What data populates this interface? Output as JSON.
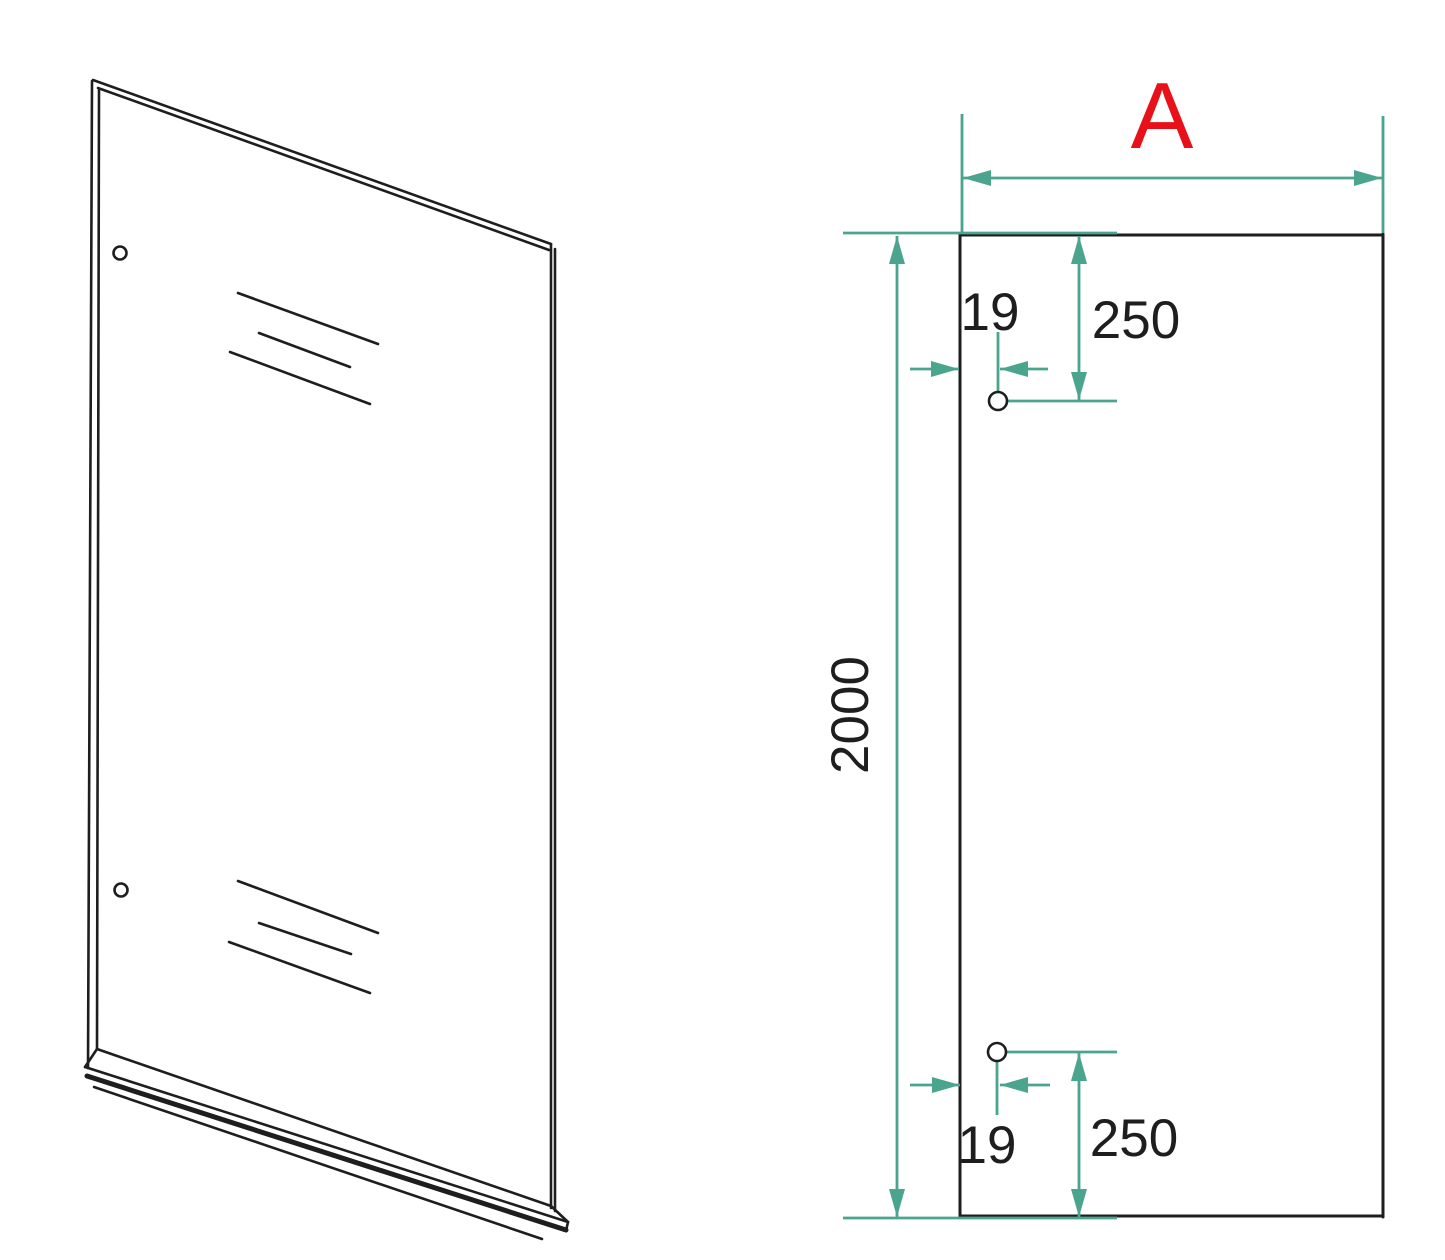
{
  "drawing": {
    "front_view": {
      "width_label": "A",
      "height_label": "2000",
      "top_hole": {
        "offset_from_edge": "19",
        "offset_from_top": "250"
      },
      "bottom_hole": {
        "offset_from_edge": "19",
        "offset_from_bottom": "250"
      }
    }
  },
  "colors": {
    "dim": "#4aa48e",
    "ink": "#1e1e1e",
    "accent": "#e8111a",
    "bg": "#ffffff"
  }
}
